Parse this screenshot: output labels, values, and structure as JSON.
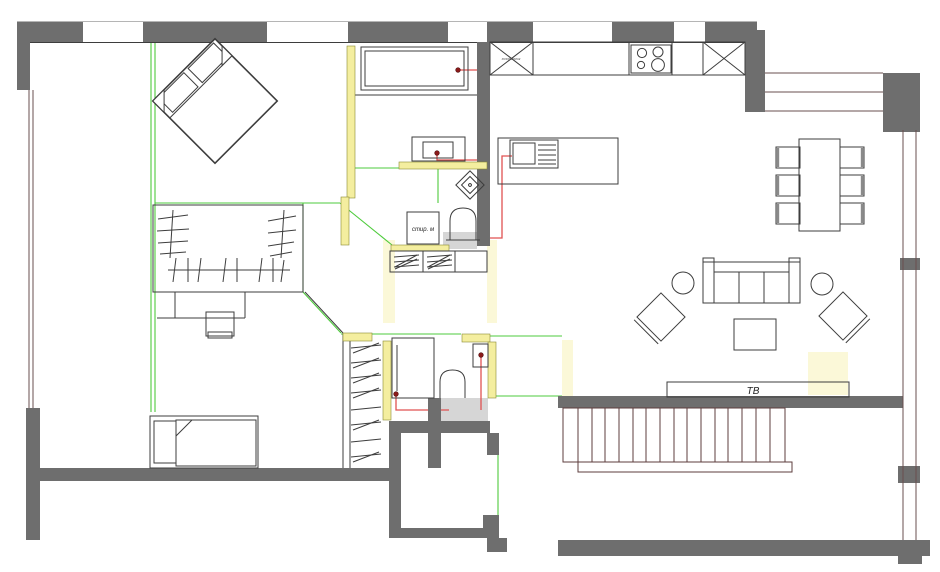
{
  "labels": {
    "tv": "ТВ",
    "washing_machine": "стир. м",
    "fridge": "холодильник"
  },
  "colors": {
    "wall": "#6e6e6e",
    "line": "#3d3d3d",
    "topline": "#b5b5b5",
    "partition": "#f4ee9f",
    "partition_border": "#8a8a33",
    "glow": "#fbf8d8",
    "floor": "#d6d6d6",
    "wire_green": "#4ecb3c",
    "wire_red": "#e05252",
    "plumb_dot": "#8b1a1a",
    "window": "#6a4f4f",
    "stair": "#5e3e3e",
    "background": "#ffffff"
  },
  "furniture": {
    "bedroom_main": [
      "double-bed",
      "wardrobe",
      "dressing-table",
      "stool"
    ],
    "bedroom_second": [
      "single-bed",
      "shelving-rack"
    ],
    "bathroom_top": [
      "bathtub",
      "washbasin",
      "water-heater",
      "washing-machine",
      "toilet"
    ],
    "bathroom_lower": [
      "shower-cabin",
      "toilet",
      "washbasin"
    ],
    "hallway": [
      "built-in-wardrobe"
    ],
    "kitchen": [
      "refrigerator",
      "kitchen-counter",
      "cooktop",
      "tall-cabinet",
      "island-with-sink"
    ],
    "dining": [
      "dining-table",
      "dining-chair",
      "dining-chair",
      "dining-chair",
      "dining-chair",
      "dining-chair",
      "dining-chair"
    ],
    "living": [
      "sofa",
      "armchair",
      "armchair",
      "side-table",
      "side-table",
      "coffee-table",
      "tv-stand"
    ],
    "outside": [
      "staircase"
    ]
  }
}
